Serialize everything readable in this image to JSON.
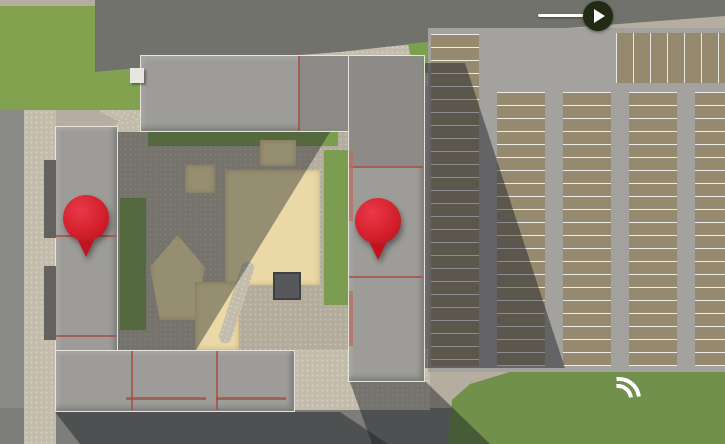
{
  "street_sign": {
    "line1": "ул. П. А. Папина",
    "line2": "(150 м)"
  },
  "parking_label": "Большая наземная парковка",
  "markers": [
    {
      "number": "1",
      "label": "позиция"
    },
    {
      "number": "2",
      "label": "позиция"
    }
  ],
  "watermark": "Restate",
  "colors": {
    "marker_red": "#d5202c",
    "sign_circle": "#202a14",
    "label_text": "#ecebe5",
    "tree_dark_outer": "#2f4d26",
    "tree_dark_inner": "#4e7034",
    "tree_bright_outer": "#4e7331",
    "tree_bright_inner": "#8cb556",
    "tree_orange_outer": "#a6661f",
    "tree_orange_inner": "#d18a33",
    "car_palette": [
      "#dcdcda",
      "#e9e9e7",
      "#2e3134",
      "#3a3d41",
      "#74787c",
      "#b9bcbe",
      "#a33236",
      "#3f5f9e",
      "#565a5f",
      "#8e9194",
      "#cfd0d1",
      "#22252a"
    ]
  }
}
